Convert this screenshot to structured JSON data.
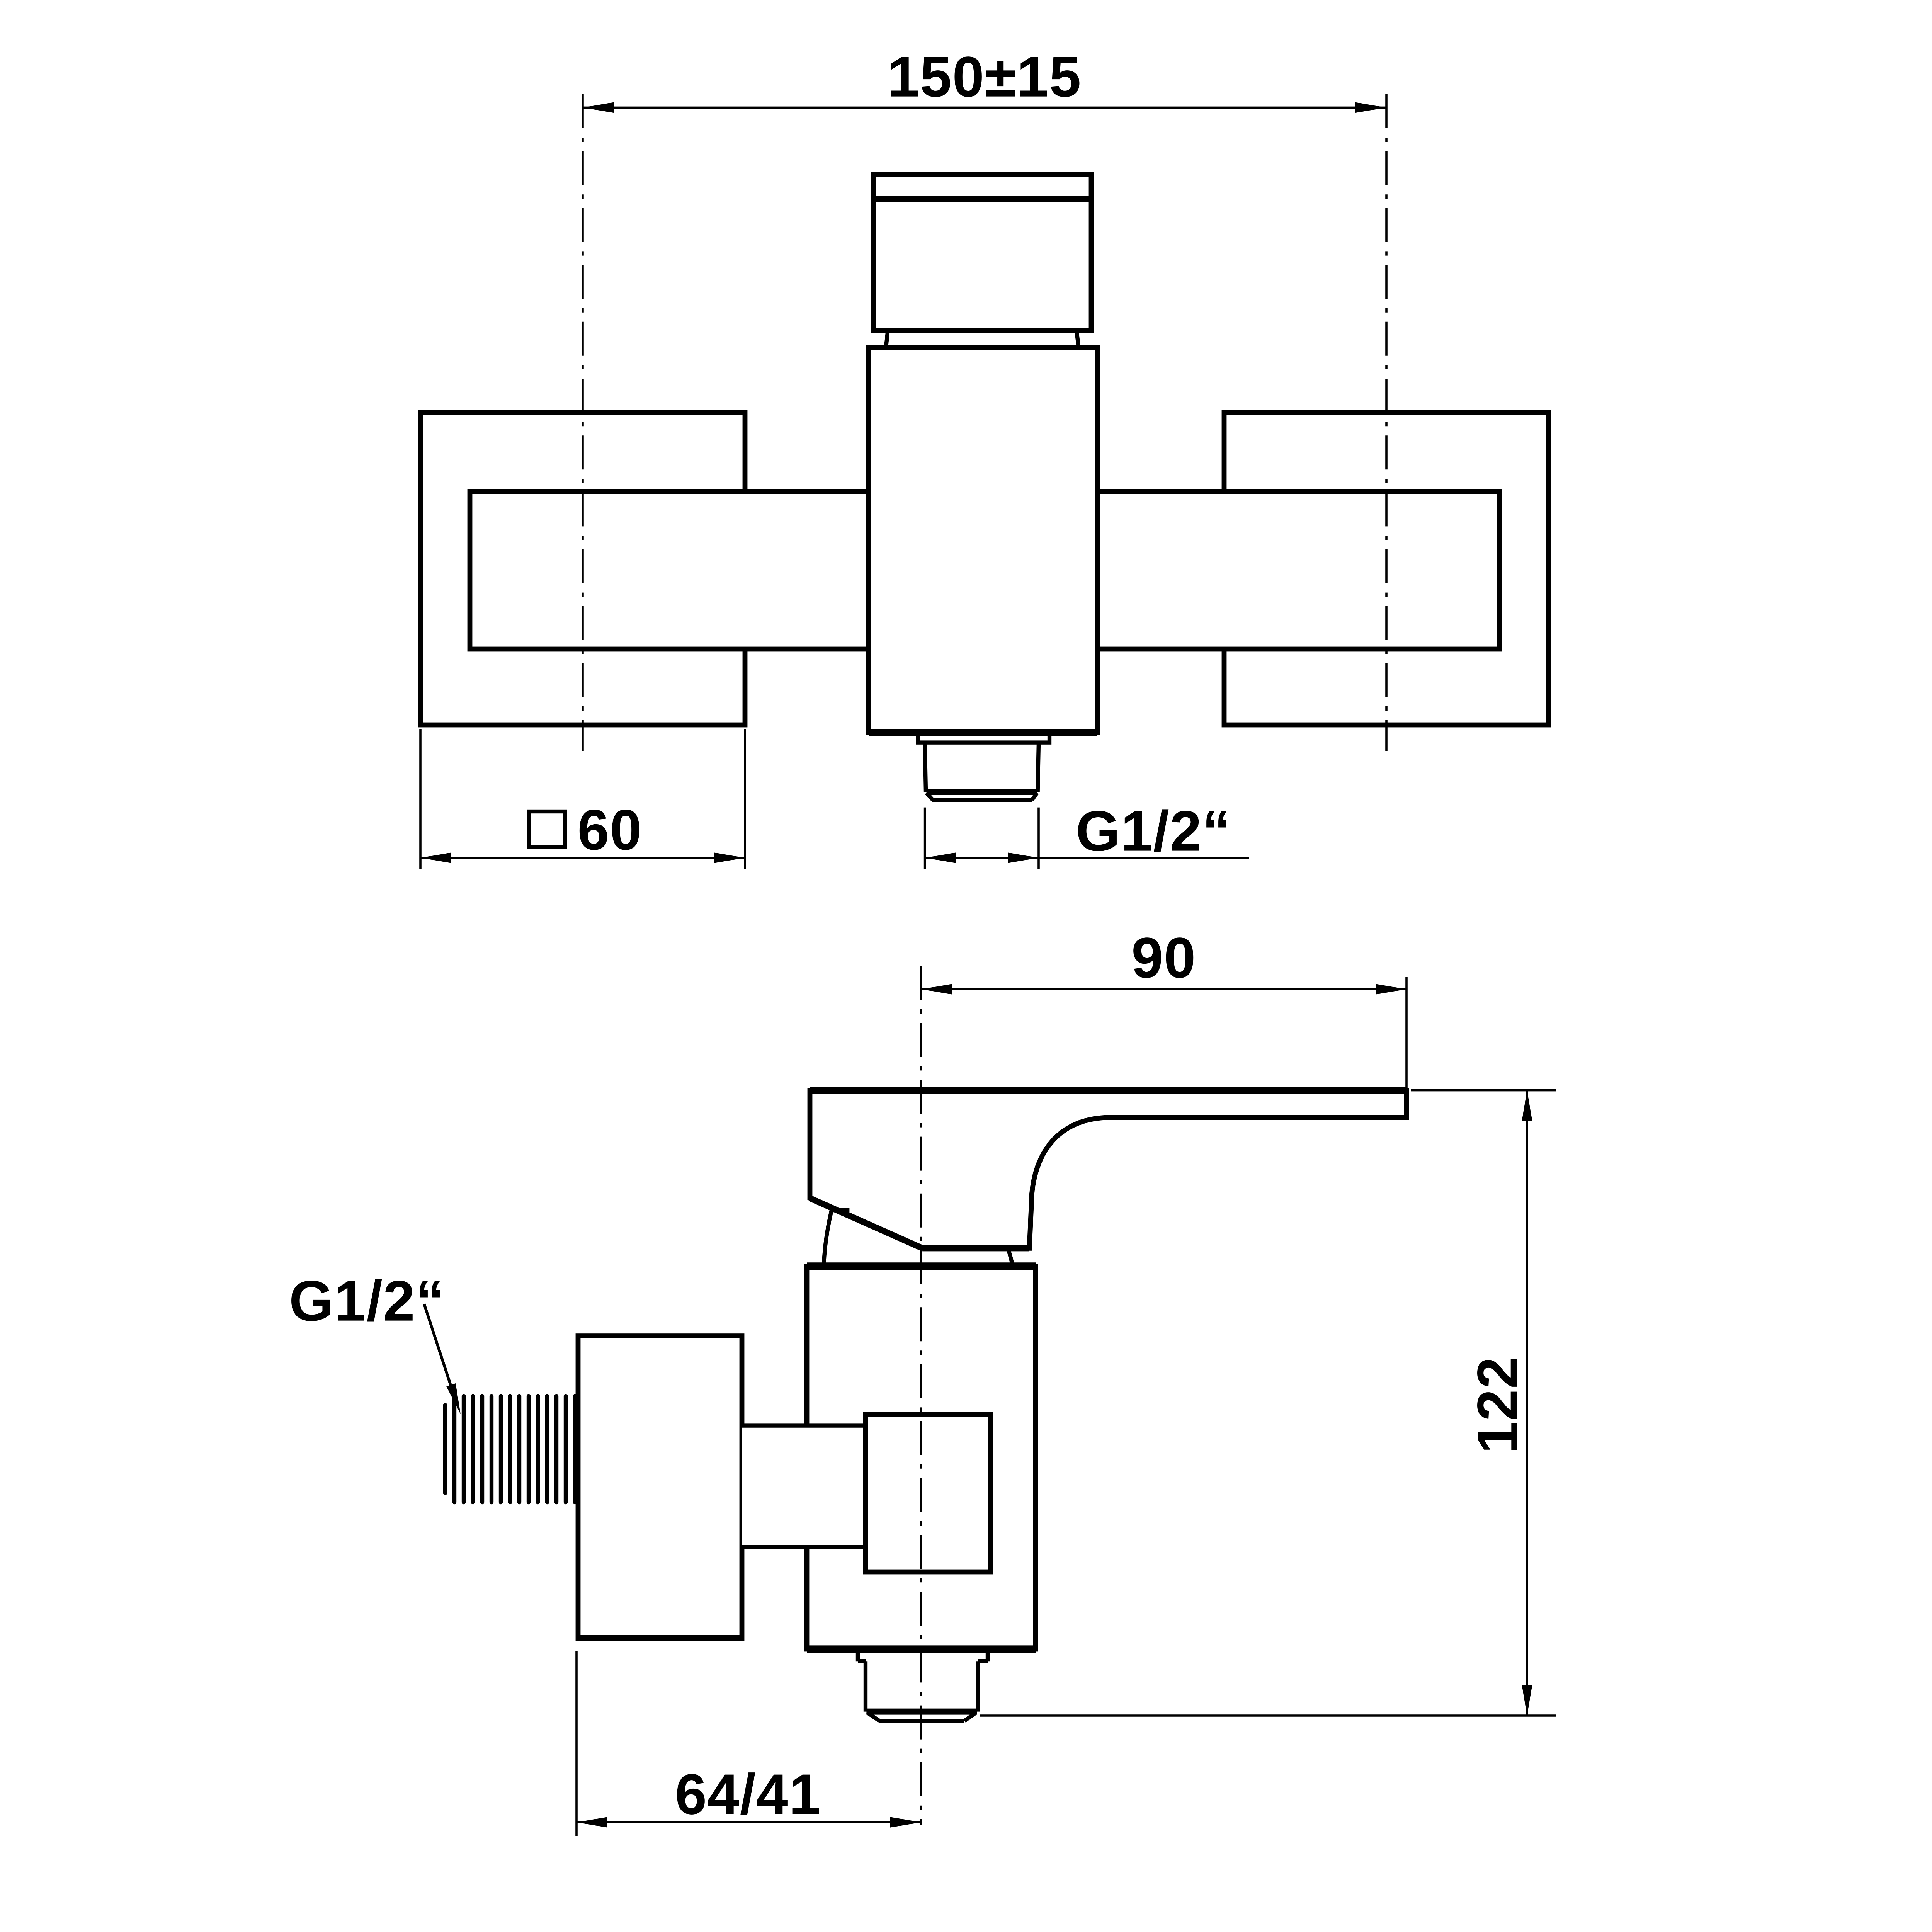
{
  "drawing": {
    "type": "technical-dimension-drawing",
    "subject": "wall-mounted single-lever shower mixer tap",
    "colors": {
      "background": "#ffffff",
      "line": "#000000",
      "text": "#000000"
    },
    "front_view": {
      "width_dim": {
        "label": "150±15"
      },
      "plate_dim": {
        "symbol": "square-symbol",
        "label": "60"
      },
      "outlet_thread_dim": {
        "label": "G1/2“"
      }
    },
    "side_view": {
      "lever_reach_dim": {
        "label": "90"
      },
      "height_dim": {
        "label": "122"
      },
      "wall_offset_dim": {
        "label": "64/41"
      },
      "inlet_thread_label": {
        "label": "G1/2“"
      }
    }
  }
}
